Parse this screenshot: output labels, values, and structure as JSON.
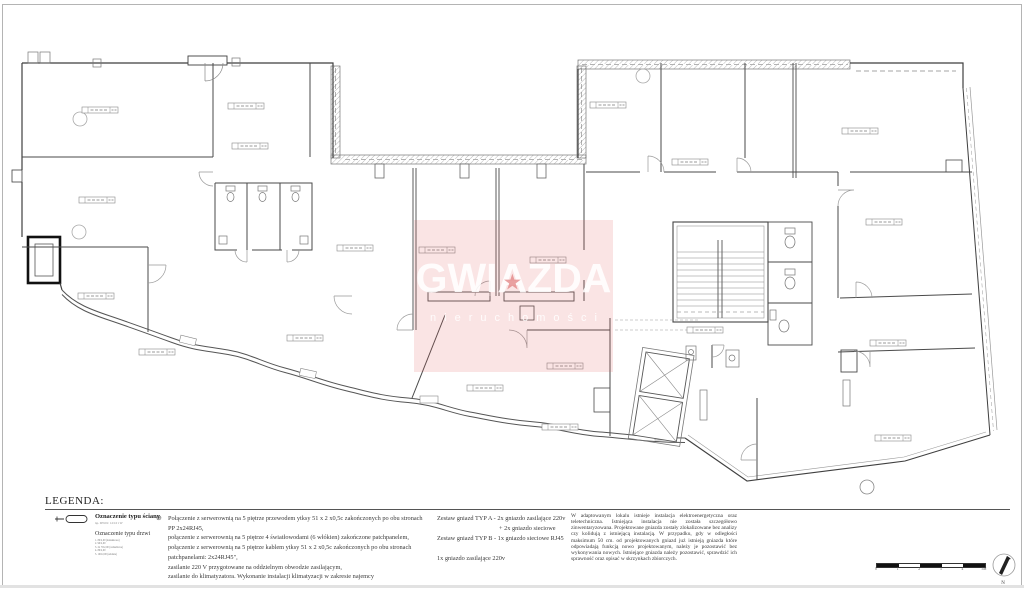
{
  "page": {
    "bg": "#ffffff",
    "frame_color": "#b4b4b4",
    "watermark_pink": "rgba(222,88,88,0.16)"
  },
  "watermark": {
    "word_start": "GWI",
    "word_mid": "A",
    "word_end": "ZDA",
    "star_icon": "★",
    "subtitle": "nieruchomości",
    "text_color": "#ffffff"
  },
  "legend": {
    "heading": "LEGENDA:",
    "wall_type_label": "Oznaczenie typu ściany",
    "wall_type_sub": "np. DW01: 12/10 i W",
    "door_type_label": "Oznaczenie typu drzwi",
    "door_type_items": [
      "1. 80/2,00 (łazienkowe)",
      "2. 90/2,00",
      "3. 2x 70/2,00 (wahadłowe)",
      "4. 80/2,00",
      "5. 100/2,00 (szklane)"
    ],
    "note_symbol": "⊕"
  },
  "notes": {
    "connection_lines": [
      "Połączenie z serwerownią na 5 piętrze przewodem ytksy 51 x 2 x0,5c zakończonych po obu stronach",
      "PP 2x24RJ45,",
      "połączenie z serwerownią na 5 piętrze 4 światłowodami (6 włókien) zakończone patchpanelem,",
      "połączenie z serwerownią na 5 piętrze kablem ytksy 51 x 2 x0,5c zakończonych po obu stronach",
      "patchpanelami:  2x24RJ45\",",
      "zasilanie 220 V przygotowane na oddzielnym obwodzie zasilającym,",
      "zasilanie do klimatyzatora. Wykonanie instalacji klimatyzacji w zakresie najemcy"
    ],
    "sockets_lines": [
      {
        "text": "Zestaw gniazd TYP A - 2x gniazdo zasilające 220v",
        "indent": 0
      },
      {
        "text": "+ 2x gniazdo sieciowe",
        "indent": 62
      },
      {
        "text": "Zestaw gniazd TYP B - 1x gniazdo sieciowe RJ45",
        "indent": 0
      },
      {
        "text": "",
        "indent": 0
      },
      {
        "text": "1x gniazdo zasilające 220v",
        "indent": 0
      }
    ],
    "paragraph": "W adaptowanym lokalu istnieje instalacja elektroenergetyczna oraz teletechniczna. Istniejąca instalacja nie została szczegółowo zinwentaryzowana. Projektowane gniazda zostały zlokalizowane bez analizy czy kolidują z istniejącą instalacją. W przypadku, gdy w odległości maksimum 50 cm. od projektowanych gniazd już istnieją gniazda które odpowiadają funkcją nowo projektowanym, należy je pozostawić bez wykonywania nowych. Istniejące gniazda należy pozostawić, sprawdzić ich sprawność oraz opisać w skrzynkach zbiorczych."
  },
  "scalebar": {
    "labels": [
      "0",
      "1",
      "2",
      "3",
      "4",
      "5M"
    ]
  },
  "north_label": "N"
}
